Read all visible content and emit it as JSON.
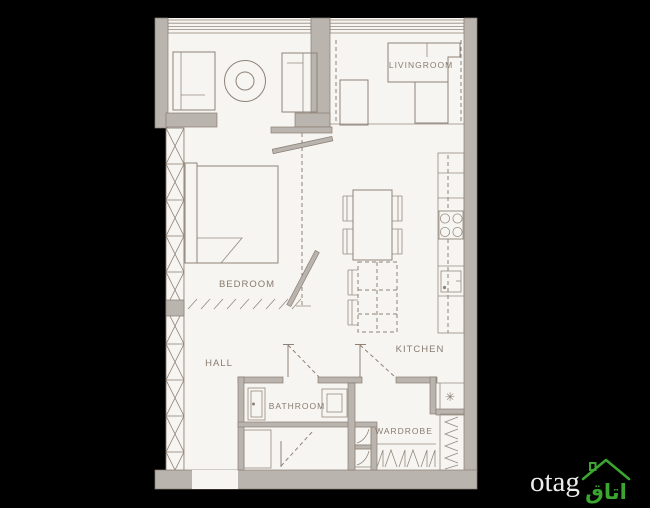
{
  "plan": {
    "canvas_background": "#000000",
    "background": "#f7f5f1",
    "wall_color": "#bab4ae",
    "line_color": "#8e8277",
    "label_color": "#877b6f",
    "rooms": {
      "livingroom": {
        "label": "LIVINGROOM"
      },
      "bedroom": {
        "label": "BEDROOM"
      },
      "hall": {
        "label": "HALL"
      },
      "kitchen": {
        "label": "KITCHEN"
      },
      "bathroom": {
        "label": "BATHROOM"
      },
      "wardrobe": {
        "label": "WARDROBE"
      }
    },
    "symbols": {
      "freezer_snowflake": "✳"
    }
  },
  "watermark": {
    "brand": "otag",
    "brand_color": "#ececec",
    "logo_text": "اتاق",
    "logo_color": "#3aa52f"
  }
}
